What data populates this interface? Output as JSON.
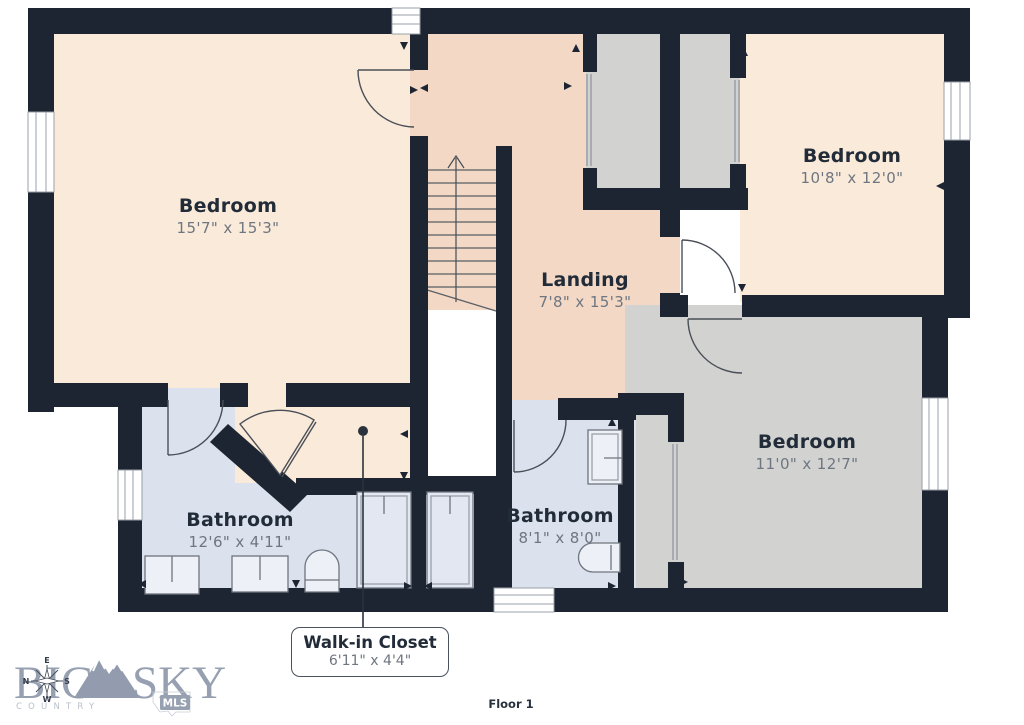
{
  "floor_plan": {
    "floor_label": "Floor 1",
    "rooms": {
      "bedroom_a": {
        "label": "Bedroom",
        "dims": "15'7\" x 15'3\""
      },
      "bedroom_b": {
        "label": "Bedroom",
        "dims": "10'8\" x 12'0\""
      },
      "landing": {
        "label": "Landing",
        "dims": "7'8\" x 15'3\""
      },
      "bedroom_c": {
        "label": "Bedroom",
        "dims": "11'0\" x 12'7\""
      },
      "bathroom_a": {
        "label": "Bathroom",
        "dims": "12'6\" x 4'11\""
      },
      "bathroom_b": {
        "label": "Bathroom",
        "dims": "8'1\" x 8'0\""
      },
      "walk_in_closet": {
        "label": "Walk-in Closet",
        "dims": "6'11\" x 4'4\""
      }
    },
    "colors": {
      "wall": "#1c2531",
      "bedroom_fill": "#faead9",
      "landing_fill": "#f2d8c5",
      "closet_fill": "#d2d2d1",
      "bathroom_fill": "#dbe1ed"
    }
  },
  "logo": {
    "word1": "BIG",
    "word2": "SKY",
    "subtitle": "COUNTRY",
    "badge": "MLS",
    "compass": {
      "top": "E",
      "left": "N",
      "right": "S",
      "bottom": "W"
    }
  }
}
